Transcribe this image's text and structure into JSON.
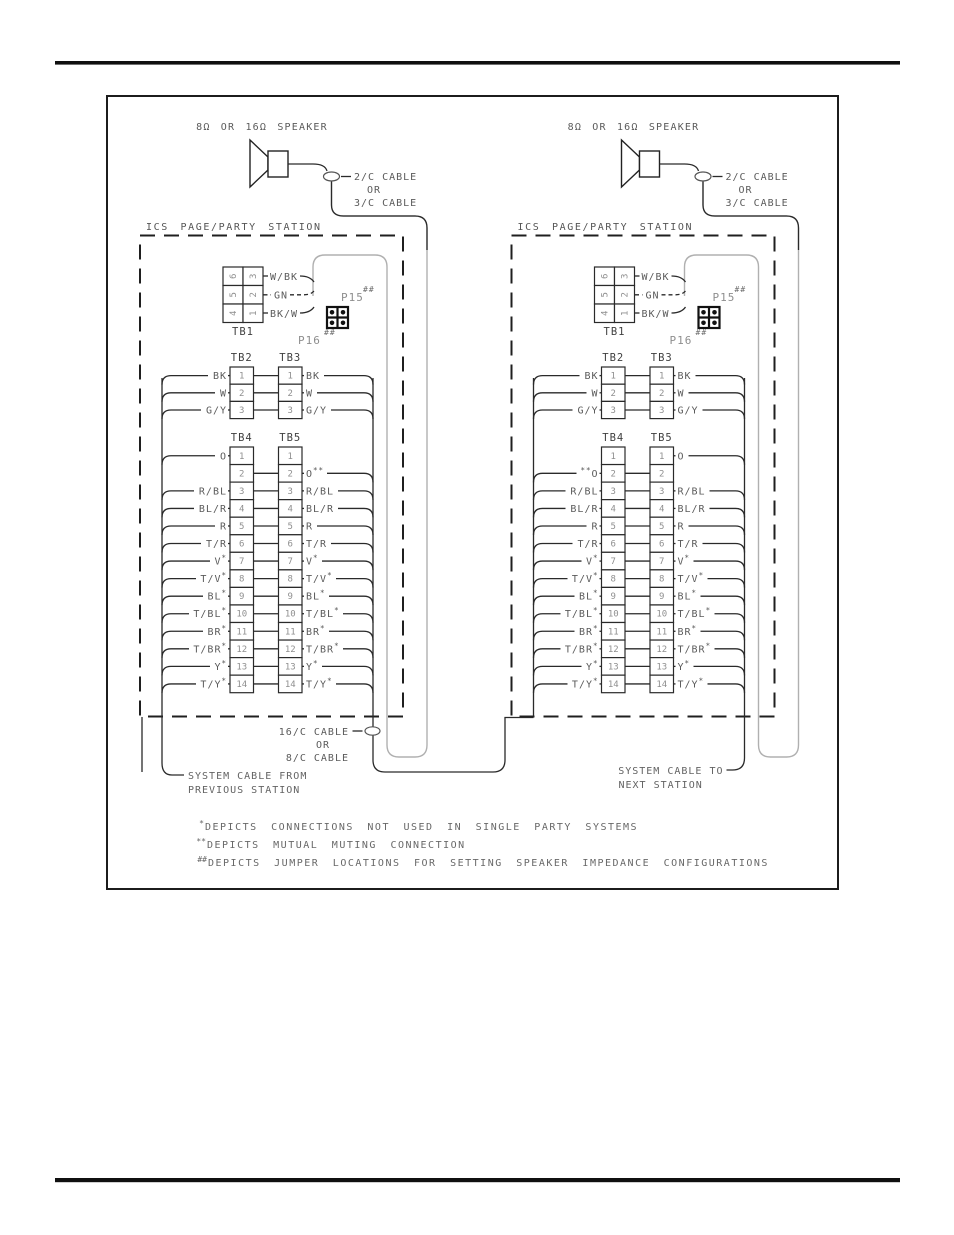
{
  "diagram": {
    "cable_mid": {
      "line1": "16/C CABLE",
      "line2": "OR",
      "line3": "8/C CABLE"
    },
    "notes": [
      {
        "prefix": "*",
        "text": "DEPICTS CONNECTIONS NOT USED IN SINGLE PARTY SYSTEMS"
      },
      {
        "prefix": "**",
        "text": "DEPICTS MUTUAL MUTING CONNECTION"
      },
      {
        "prefix": "##",
        "text": "DEPICTS JUMPER LOCATIONS FOR SETTING SPEAKER IMPEDANCE CONFIGURATIONS"
      }
    ],
    "stations": [
      {
        "speaker_label": "8Ω OR 16Ω SPEAKER",
        "cable_label": [
          "2/C CABLE",
          "OR",
          "3/C CABLE"
        ],
        "station_label": "ICS PAGE/PARTY STATION",
        "tb1": {
          "caption": "TB1",
          "left_col": [
            "6",
            "5",
            "4"
          ],
          "right_col": [
            "3",
            "2",
            "1"
          ],
          "wire_labels": [
            "W/BK",
            "GN",
            "BK/W"
          ]
        },
        "p15_label": "P15",
        "p15_sup": "##",
        "p16_label": "P16",
        "p16_sup": "##",
        "tb23": {
          "captions": [
            "TB2",
            "TB3"
          ],
          "rows": [
            {
              "n": "1",
              "left": "BK",
              "right": "BK"
            },
            {
              "n": "2",
              "left": "W",
              "right": "W"
            },
            {
              "n": "3",
              "left": "G/Y",
              "right": "G/Y"
            }
          ]
        },
        "tb45": {
          "captions": [
            "TB4",
            "TB5"
          ],
          "rows": [
            {
              "n": "1",
              "left": "O",
              "right": "",
              "link": false
            },
            {
              "n": "2",
              "left": "",
              "right": "O",
              "right_sup": "**",
              "link": true
            },
            {
              "n": "3",
              "left": "R/BL",
              "right": "R/BL",
              "link": true
            },
            {
              "n": "4",
              "left": "BL/R",
              "right": "BL/R",
              "link": true
            },
            {
              "n": "5",
              "left": "R",
              "right": "R",
              "link": true
            },
            {
              "n": "6",
              "left": "T/R",
              "right": "T/R",
              "link": true
            },
            {
              "n": "7",
              "left": "V",
              "left_sup": "*",
              "right": "V",
              "right_sup": "*",
              "link": true
            },
            {
              "n": "8",
              "left": "T/V",
              "left_sup": "*",
              "right": "T/V",
              "right_sup": "*",
              "link": true
            },
            {
              "n": "9",
              "left": "BL",
              "left_sup": "*",
              "right": "BL",
              "right_sup": "*",
              "link": true
            },
            {
              "n": "10",
              "left": "T/BL",
              "left_sup": "*",
              "right": "T/BL",
              "right_sup": "*",
              "link": true
            },
            {
              "n": "11",
              "left": "BR",
              "left_sup": "*",
              "right": "BR",
              "right_sup": "*",
              "link": true
            },
            {
              "n": "12",
              "left": "T/BR",
              "left_sup": "*",
              "right": "T/BR",
              "right_sup": "*",
              "link": true
            },
            {
              "n": "13",
              "left": "Y",
              "left_sup": "*",
              "right": "Y",
              "right_sup": "*",
              "link": true
            },
            {
              "n": "14",
              "left": "T/Y",
              "left_sup": "*",
              "right": "T/Y",
              "right_sup": "*",
              "link": true
            }
          ]
        },
        "bottom_label": [
          "SYSTEM CABLE FROM",
          "PREVIOUS STATION"
        ]
      },
      {
        "speaker_label": "8Ω OR 16Ω SPEAKER",
        "cable_label": [
          "2/C CABLE",
          "OR",
          "3/C CABLE"
        ],
        "station_label": "ICS PAGE/PARTY STATION",
        "tb1": {
          "caption": "TB1",
          "left_col": [
            "6",
            "5",
            "4"
          ],
          "right_col": [
            "3",
            "2",
            "1"
          ],
          "wire_labels": [
            "W/BK",
            "GN",
            "BK/W"
          ]
        },
        "p15_label": "P15",
        "p15_sup": "##",
        "p16_label": "P16",
        "p16_sup": "##",
        "tb23": {
          "captions": [
            "TB2",
            "TB3"
          ],
          "rows": [
            {
              "n": "1",
              "left": "BK",
              "right": "BK"
            },
            {
              "n": "2",
              "left": "W",
              "right": "W"
            },
            {
              "n": "3",
              "left": "G/Y",
              "right": "G/Y"
            }
          ]
        },
        "tb45": {
          "captions": [
            "TB4",
            "TB5"
          ],
          "rows": [
            {
              "n": "1",
              "left": "",
              "right": "O",
              "link": false
            },
            {
              "n": "2",
              "left": "O",
              "left_sup_pre": "**",
              "right": "",
              "link": true
            },
            {
              "n": "3",
              "left": "R/BL",
              "right": "R/BL",
              "link": true
            },
            {
              "n": "4",
              "left": "BL/R",
              "right": "BL/R",
              "link": true
            },
            {
              "n": "5",
              "left": "R",
              "right": "R",
              "link": true
            },
            {
              "n": "6",
              "left": "T/R",
              "right": "T/R",
              "link": true
            },
            {
              "n": "7",
              "left": "V",
              "left_sup": "*",
              "right": "V",
              "right_sup": "*",
              "link": true
            },
            {
              "n": "8",
              "left": "T/V",
              "left_sup": "*",
              "right": "T/V",
              "right_sup": "*",
              "link": true
            },
            {
              "n": "9",
              "left": "BL",
              "left_sup": "*",
              "right": "BL",
              "right_sup": "*",
              "link": true
            },
            {
              "n": "10",
              "left": "T/BL",
              "left_sup": "*",
              "right": "T/BL",
              "right_sup": "*",
              "link": true
            },
            {
              "n": "11",
              "left": "BR",
              "left_sup": "*",
              "right": "BR",
              "right_sup": "*",
              "link": true
            },
            {
              "n": "12",
              "left": "T/BR",
              "left_sup": "*",
              "right": "T/BR",
              "right_sup": "*",
              "link": true
            },
            {
              "n": "13",
              "left": "Y",
              "left_sup": "*",
              "right": "Y",
              "right_sup": "*",
              "link": true
            },
            {
              "n": "14",
              "left": "T/Y",
              "left_sup": "*",
              "right": "T/Y",
              "right_sup": "*",
              "link": true
            }
          ]
        },
        "bottom_label": [
          "SYSTEM CABLE TO",
          "NEXT STATION"
        ]
      }
    ]
  }
}
